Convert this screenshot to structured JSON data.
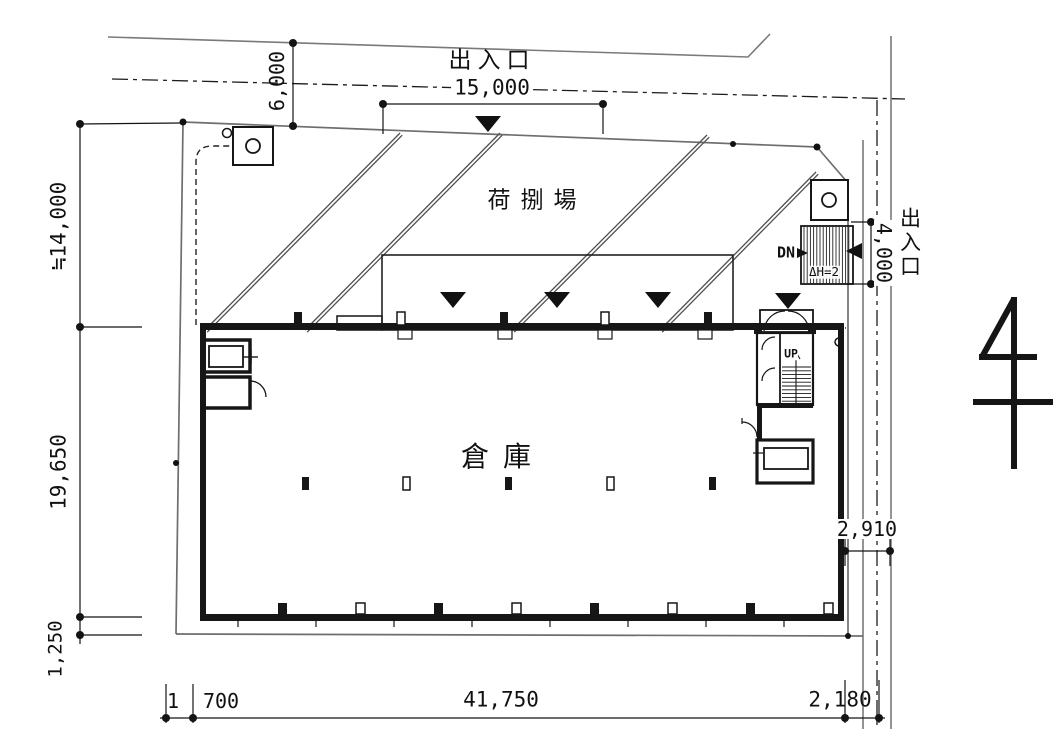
{
  "labels": {
    "entrance_top": "出入口",
    "entrance_right": "出入口",
    "loading_area": "荷捌場",
    "warehouse": "倉庫",
    "stair_up": "UP",
    "ramp_down": "DN",
    "height_difference": "ΔH=2"
  },
  "dimensions": {
    "entrance_top_width": "15,000",
    "front_road_width": "6,000",
    "site_west_upper": "≒14,000",
    "site_west_middle": "19,650",
    "site_west_lower": "1,250",
    "south_offset_left_a": "1",
    "south_offset_left_b": "700",
    "building_length": "41,750",
    "south_offset_right": "2,180",
    "entrance_right_width": "4,000",
    "side_road_width": "2,910"
  }
}
